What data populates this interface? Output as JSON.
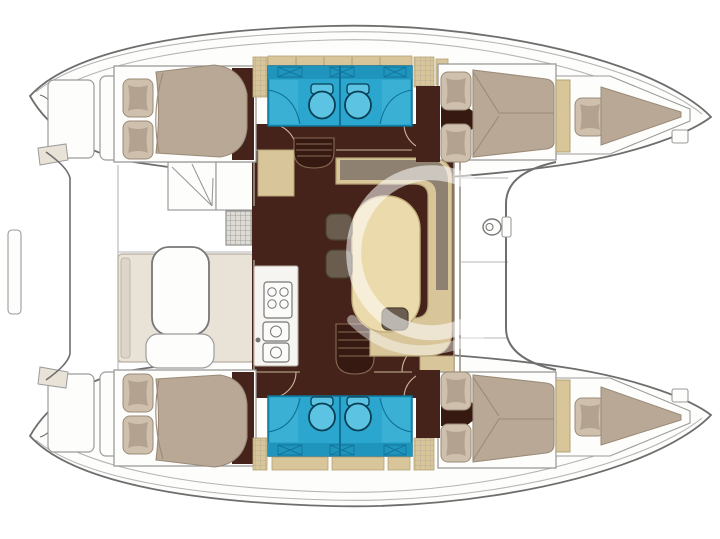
{
  "figure": {
    "kind": "catamaran-deck-plan",
    "orientation": "top view, bows pointing right"
  },
  "rooms": [
    "port aft cabin",
    "port heads compartment",
    "port forward cabin",
    "port forepeak berth",
    "starboard aft cabin",
    "starboard heads compartment",
    "starboard forward cabin",
    "starboard forepeak berth",
    "saloon",
    "galley",
    "cockpit",
    "foredeck trampoline",
    "transom steps"
  ],
  "features": {
    "double_berths": 4,
    "forepeak_berths": 2,
    "toilets": 4,
    "shower_trays": 4,
    "stove_burners": 4,
    "galley_sinks": 2,
    "saloon_tables": 1,
    "cockpit_tables": 1,
    "stools": 2,
    "pillows": 10
  },
  "colors": {
    "background": "#ffffff",
    "hullStroke": "#6e6e6e",
    "deckLine": "#b5b5b5",
    "wallLine": "#9a9288",
    "roomStroke": "#9b9b9b",
    "whiteFill": "#fdfdfb",
    "floor": "#45231a",
    "floorDark": "#361a12",
    "stepLine": "#8a6a55",
    "doorArc": "#c9b49b",
    "furnitureBeige": "#d8c59a",
    "furnitureBeigeStroke": "#b5a275",
    "backrestTaupe": "#8e8172",
    "tableCream": "#ebdaab",
    "tableStroke": "#c4ae7d",
    "mattress": "#b9a896",
    "mattressStroke": "#9a8a78",
    "pillowOuter": "#cfc0ae",
    "pillowInner": "#b3a28f",
    "bathroom": "#2ba7cf",
    "bathroomBand": "#1f94bd",
    "bathroomStroke": "#0e7195",
    "trayBlue": "#45b6d9",
    "toiletFill": "#5cc3e2",
    "toiletStroke": "#073f55",
    "benchFill": "#e9e3d7",
    "benchBack": "#ddd6c8",
    "benchStroke": "#b6afa2",
    "counterFill": "#f7f5f1",
    "applianceFill": "#fbfbf9",
    "applianceStroke": "#777777",
    "grateFill": "#dedbd4",
    "grateLine": "#8f8f8f",
    "stoolFill": "#6a5d50",
    "stoolStroke": "#49402f",
    "watermark": "rgba(255,255,255,0.55)",
    "watermark2": "rgba(255,255,255,0.45)"
  }
}
